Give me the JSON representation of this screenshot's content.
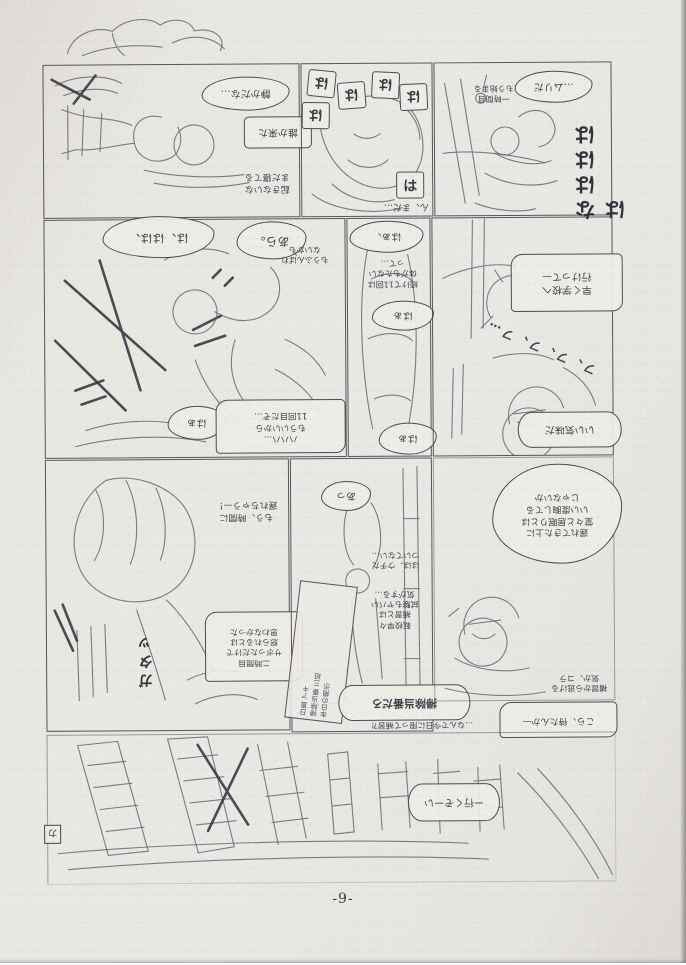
{
  "footer": {
    "page_number": "-9-"
  },
  "palette": {
    "paper": "#eae8e4",
    "margin": "#dcd9d5",
    "pencil": "#615e6b",
    "ink": "#3a3843"
  },
  "panels": {
    "r1c1": {
      "bubbles": [
        {
          "text": "静かだな…"
        },
        {
          "text": "誰か来た"
        },
        {
          "text": "起きないな\nまだ寝てる"
        }
      ]
    },
    "r1c2": {
      "pant_small": [
        "は",
        "は",
        "は",
        "は",
        "は"
      ],
      "bubbles": [
        {
          "text": "は"
        },
        {
          "text": "ん、まだ…"
        }
      ]
    },
    "r1c3": {
      "bubbles": [
        {
          "text": "…ムリだ"
        },
        {
          "text": "一時間目\nもう始まる"
        }
      ],
      "vertical_sound": "なはははは"
    },
    "r2c1": {
      "bubbles": [
        {
          "text": "は、はは、"
        },
        {
          "text": "あら。"
        },
        {
          "text": "もうふんばれ\nないかも"
        },
        {
          "text": "はぁ"
        },
        {
          "text": "ハハハ…\nもういいから\n11回目だぞ…"
        }
      ]
    },
    "r2c2": {
      "bubbles": [
        {
          "text": "はぁ、"
        },
        {
          "text": "続けて11回は\n体がもたない\nって…"
        },
        {
          "text": "はぁ"
        },
        {
          "text": "はぁ"
        }
      ]
    },
    "r2c3": {
      "bubbles": [
        {
          "text": "早く学校へ\n行けって—"
        },
        {
          "text": "いい気味だ"
        }
      ],
      "laugh": "フ、フ、フ、フ…"
    },
    "r3c1": {
      "bubbles": [
        {
          "text": "もう、時間に\n遅れちゃう—！"
        },
        {
          "text": "二時間目\nサボっただけで\n怒られるとは\n思わなかった"
        }
      ],
      "vertical_sound": "ガタッ"
    },
    "r3c2": {
      "bubbles": [
        {
          "text": "あっ"
        },
        {
          "text": "はは、ウチだ\nついてない…"
        },
        {
          "text": "転校早々\n補習とは\n試験もヤバい\n気がする…"
        },
        {
          "text": "掃除当番だろ"
        },
        {
          "text": "…なんで今日に限って補習⁈"
        }
      ],
      "sign_columns": [
        "本日の掲示",
        "掃除当番 三班",
        "日直 アキ"
      ]
    },
    "r3c3": {
      "bubbles": [
        {
          "text": "遅れてきた上に\n堂々と居眠りとは\nいい度胸してる\nじゃないか"
        },
        {
          "text": "補習から逃げる\n気か、コラ"
        },
        {
          "text": "こら、待たんか—"
        }
      ]
    },
    "r4": {
      "bubbles": [
        {
          "text": "ー行くぞーい"
        }
      ],
      "corner_mark": "カ"
    }
  }
}
